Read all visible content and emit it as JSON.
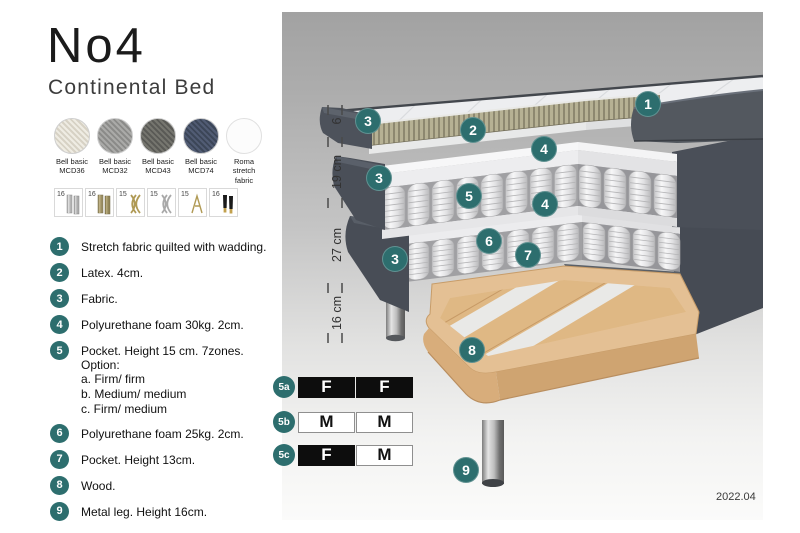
{
  "header": {
    "title": "No4",
    "subtitle": "Continental Bed"
  },
  "fabrics": [
    {
      "label": "Bell basic MCD36"
    },
    {
      "label": "Bell basic MCD32"
    },
    {
      "label": "Bell basic MCD43"
    },
    {
      "label": "Bell basic MCD74"
    },
    {
      "label": "Roma stretch fabric"
    }
  ],
  "legs_options": [
    {
      "height": "16",
      "style": "cylinder-silver"
    },
    {
      "height": "16",
      "style": "cylinder-brass"
    },
    {
      "height": "15",
      "style": "wave-gold"
    },
    {
      "height": "15",
      "style": "wave-silver"
    },
    {
      "height": "15",
      "style": "hairpin-gold"
    },
    {
      "height": "16",
      "style": "cone-black-gold"
    }
  ],
  "parts": [
    {
      "num": "1",
      "text": "Stretch fabric quilted with wadding."
    },
    {
      "num": "2",
      "text": "Latex. 4cm."
    },
    {
      "num": "3",
      "text": "Fabric."
    },
    {
      "num": "4",
      "text": "Polyurethane foam 30kg. 2cm."
    },
    {
      "num": "5",
      "text": "Pocket. Height 15 cm. 7zones. Option:",
      "options": [
        "a. Firm/ firm",
        "b. Medium/ medium",
        "c. Firm/ medium"
      ]
    },
    {
      "num": "6",
      "text": "Polyurethane foam 25kg. 2cm."
    },
    {
      "num": "7",
      "text": "Pocket. Height 13cm."
    },
    {
      "num": "8",
      "text": "Wood."
    },
    {
      "num": "9",
      "text": "Metal leg. Height 16cm."
    }
  ],
  "diagram": {
    "dimensions": [
      {
        "label": "6"
      },
      {
        "label": "19 cm"
      },
      {
        "label": "27 cm"
      },
      {
        "label": "16 cm"
      }
    ],
    "callouts": [
      {
        "label": "1"
      },
      {
        "label": "2"
      },
      {
        "label": "3"
      },
      {
        "label": "4"
      },
      {
        "label": "3"
      },
      {
        "label": "5"
      },
      {
        "label": "4"
      },
      {
        "label": "6"
      },
      {
        "label": "7"
      },
      {
        "label": "3"
      },
      {
        "label": "8"
      },
      {
        "label": "9"
      }
    ],
    "firmness": [
      {
        "id": "5a",
        "cells": [
          {
            "t": "F",
            "fill": "black"
          },
          {
            "t": "F",
            "fill": "black"
          }
        ]
      },
      {
        "id": "5b",
        "cells": [
          {
            "t": "M",
            "fill": "white"
          },
          {
            "t": "M",
            "fill": "white"
          }
        ]
      },
      {
        "id": "5c",
        "cells": [
          {
            "t": "F",
            "fill": "black"
          },
          {
            "t": "M",
            "fill": "white"
          }
        ]
      }
    ],
    "version": "2022.04",
    "colors": {
      "accent_teal": "#2d6e6e"
    }
  }
}
